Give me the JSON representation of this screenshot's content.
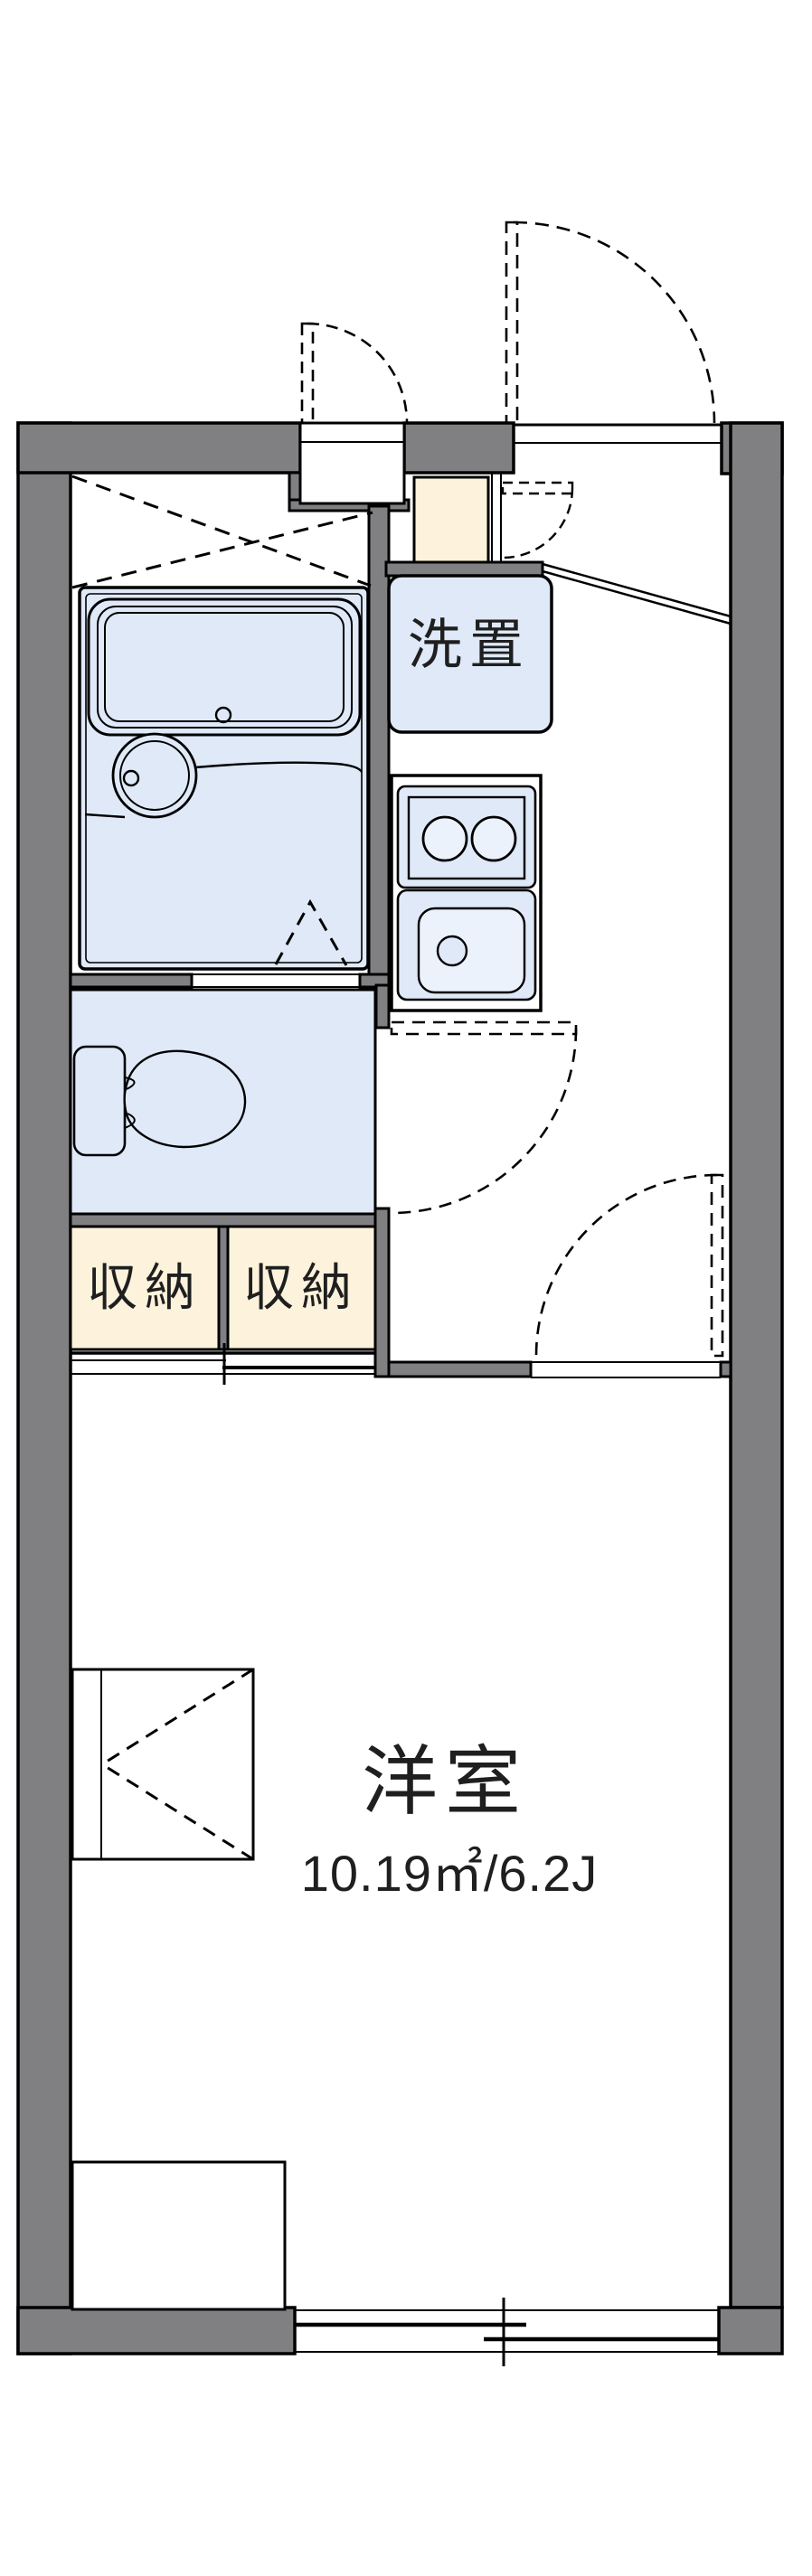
{
  "plan": {
    "title": "apartment-floor-plan",
    "labels": {
      "washer": "洗置",
      "storage_left": "収納",
      "storage_right": "収納",
      "main_room": "洋室",
      "main_room_size": "10.19㎡/6.2J"
    },
    "rooms": [
      {
        "name": "unit-bath",
        "fixtures": [
          "bathtub",
          "wash-basin",
          "drain"
        ]
      },
      {
        "name": "toilet",
        "fixtures": [
          "toilet-tank",
          "toilet-bowl"
        ]
      },
      {
        "name": "washer-space",
        "label": "洗置"
      },
      {
        "name": "kitchen",
        "fixtures": [
          "two-burner-stove",
          "sink"
        ]
      },
      {
        "name": "storage",
        "label": "収納",
        "count": 2
      },
      {
        "name": "western-room",
        "label": "洋室",
        "area_m2": "10.19",
        "area_jo": "6.2J"
      }
    ],
    "colors": {
      "wall": "#808083",
      "fixture_blue": "#dfe9f8",
      "fixture_blue_light": "#ecf2fc",
      "tatami_cream": "#fdf3dc",
      "line": "#000000",
      "background": "#ffffff"
    }
  }
}
